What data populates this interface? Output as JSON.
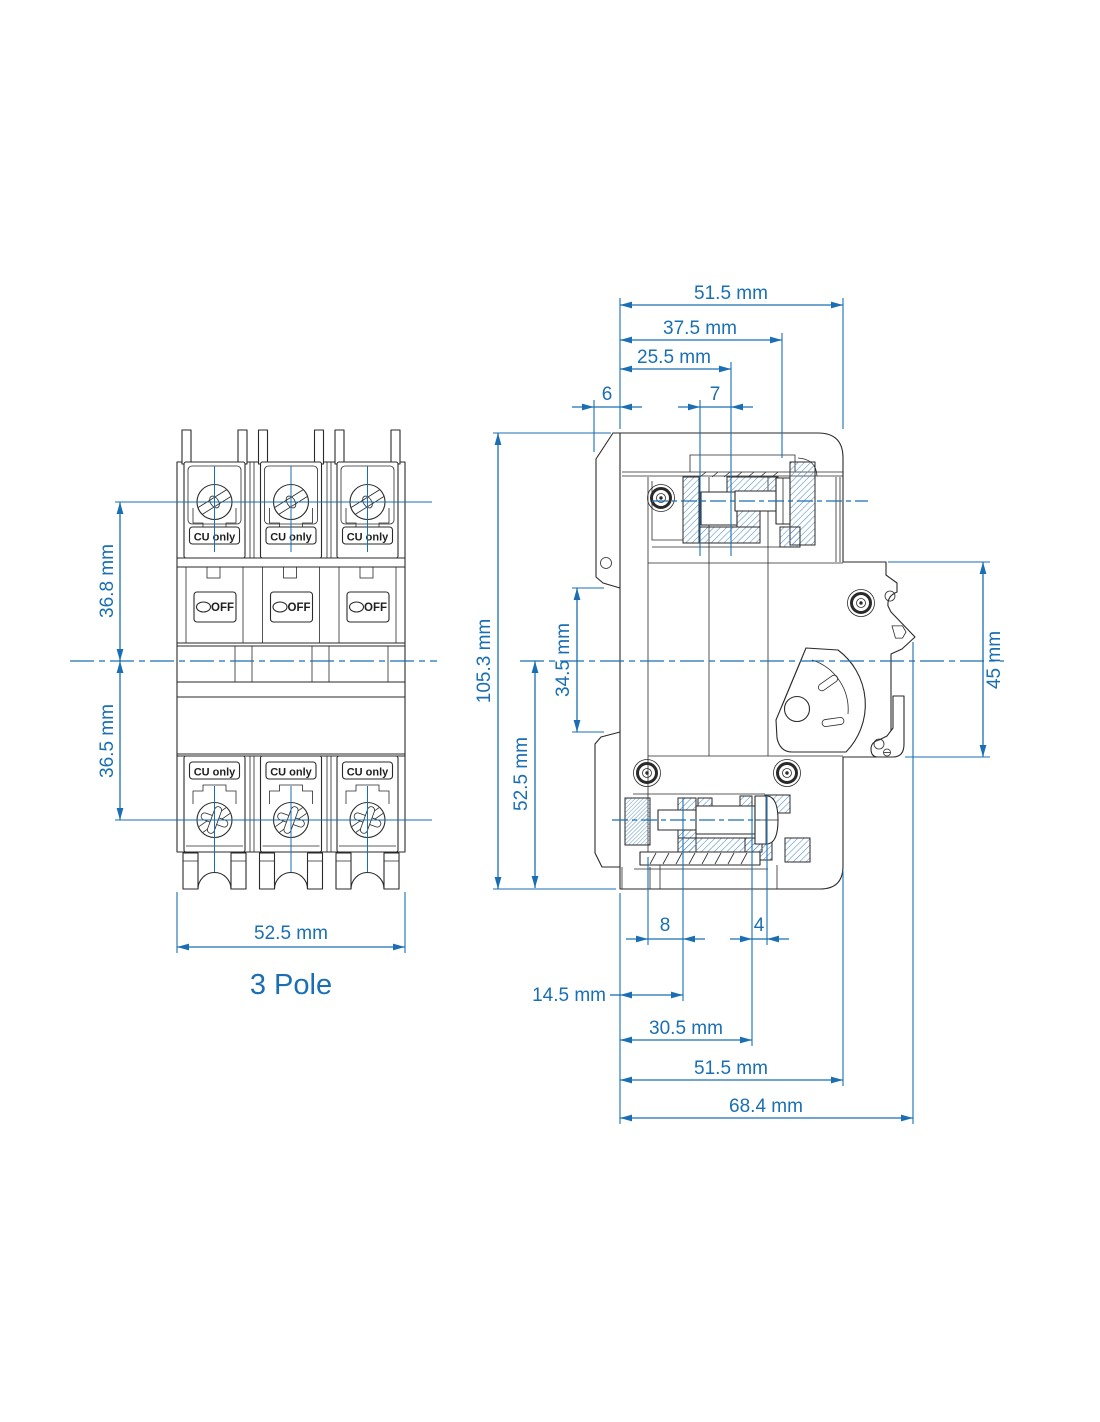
{
  "front": {
    "caption": "3 Pole",
    "cu_only": "CU only",
    "off_indicator": "OFF",
    "dim_upper_half": "36.8 mm",
    "dim_lower_half": "36.5 mm",
    "dim_width": "52.5 mm"
  },
  "side": {
    "dim_depth_overall": "51.5 mm",
    "dim_depth_mid": "37.5 mm",
    "dim_depth_front": "25.5 mm",
    "dim_flange": "6",
    "dim_terminal_opening": "7",
    "dim_height_overall": "105.3 mm",
    "dim_rail_notch": "34.5 mm",
    "dim_lower_half": "52.5 mm",
    "dim_din_section": "45 mm",
    "dim_bottom_small_left": "8",
    "dim_bottom_small_right": "4",
    "dim_bottom_1": "14.5 mm",
    "dim_bottom_2": "30.5 mm",
    "dim_bottom_3": "51.5 mm",
    "dim_bottom_overall": "68.4 mm"
  },
  "colors": {
    "dimension_blue": "#1a6fb4",
    "hatch_blue": "#4d8dc6",
    "line_black": "#2a2a2a"
  }
}
